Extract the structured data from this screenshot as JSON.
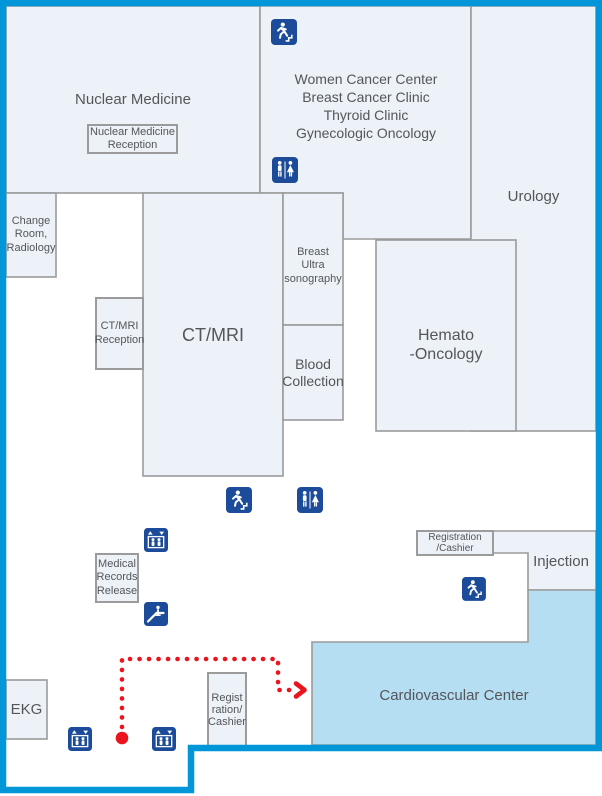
{
  "map": {
    "name": "hospital-floor-map",
    "rooms": {
      "nuclear_medicine": "Nuclear Medicine",
      "nuclear_medicine_reception": "Nuclear Medicine\nReception",
      "women_cancer_center": "Women Cancer Center\nBreast Cancer Clinic\nThyroid Clinic\nGynecologic Oncology",
      "urology": "Urology",
      "change_room_radiology": "Change\nRoom,\nRadiology",
      "ct_mri_reception": "CT/MRI\nReception",
      "ct_mri": "CT/MRI",
      "breast_ultrasonography": "Breast\nUltra\nsonography",
      "blood_collection": "Blood\nCollection",
      "hemato_oncology": "Hemato\n-Oncology",
      "registration_cashier_upper": "Registration\n/Cashier",
      "injection": "Injection",
      "medical_records_release": "Medical\nRecords\nRelease",
      "ekg": "EKG",
      "registration_cashier_lower": "Regist\nration/\nCashier",
      "cardiovascular_center": "Cardiovascular Center"
    },
    "icons": {
      "emergency_exit": "running-person-with-stairs",
      "restroom": "men-women-restroom",
      "elevator": "elevator-up-down-arrows-with-people",
      "escalator": "person-on-escalator"
    },
    "colors": {
      "outer_border": "#0096d8",
      "room_fill": "#ecf2f7",
      "room_stroke": "#9b9b9b",
      "highlight_fill": "#b5def2",
      "icon_background": "#1c4c99",
      "route_red": "#e9141d",
      "text": "#54565a"
    },
    "route": {
      "style": "red-dotted-line",
      "start_marker": "dot",
      "end_marker": "arrow-into-cardiovascular-center"
    }
  }
}
